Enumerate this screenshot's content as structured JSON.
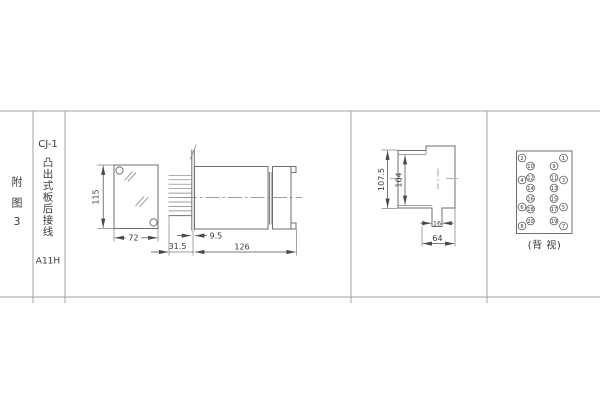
{
  "figure_label": {
    "chars": [
      "附",
      "图",
      "3"
    ]
  },
  "spec": {
    "model": "CJ-1",
    "mounting": "凸出式板后接线",
    "mounting_chars": [
      "凸",
      "出",
      "式",
      "板",
      "后",
      "接",
      "线"
    ],
    "code": "A11H"
  },
  "front_view": {
    "height": "115",
    "width": "72"
  },
  "side_view": {
    "panel_offset": "9.5",
    "front_depth": "31.5",
    "total_depth": "126"
  },
  "case_view": {
    "outer_height": "107.5",
    "inner_height": "104",
    "slot_width": "16",
    "width": "64"
  },
  "terminals": {
    "label": "(背 视)",
    "left_outer": [
      "2",
      "4",
      "6",
      "8"
    ],
    "left_inner": [
      "10",
      "12",
      "14",
      "16",
      "18",
      "20"
    ],
    "right_inner": [
      "9",
      "11",
      "13",
      "15",
      "17",
      "19"
    ],
    "right_outer": [
      "1",
      "3",
      "5",
      "7"
    ]
  },
  "colors": {
    "background": "#ffffff",
    "drawing_line": "#6f6f6f",
    "table_line": "#a3a3a3",
    "text": "#3a3a3a"
  }
}
